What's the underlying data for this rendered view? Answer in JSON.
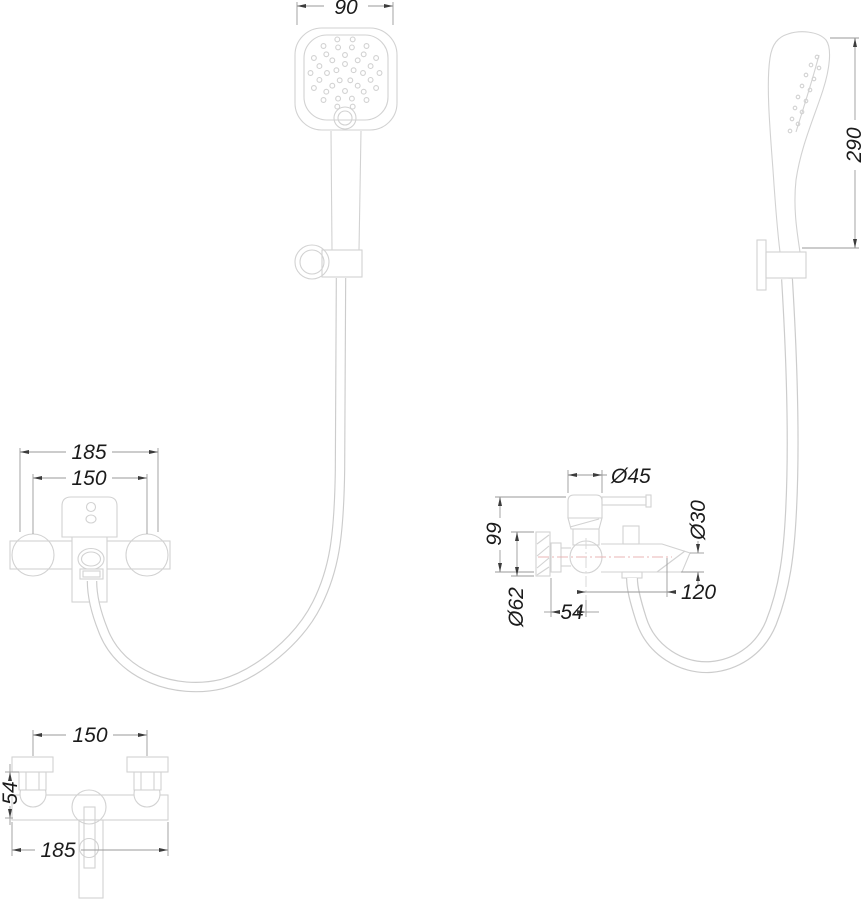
{
  "colors": {
    "outline": "#d2d2d2",
    "hose": "#cccccc",
    "dimension": "#9a9a9a",
    "arrow": "#3c3c3c",
    "text": "#1b1b1b",
    "centerline": "#e8b4b4"
  },
  "dims": {
    "head_width": "90",
    "handset_height": "290",
    "front_overall": "185",
    "front_centers": "150",
    "side_cartridge": "Ø45",
    "side_height": "99",
    "side_flange": "Ø62",
    "side_depth": "54",
    "side_spout": "Ø30",
    "side_reach": "120",
    "top_centers": "150",
    "top_depth": "54",
    "top_overall": "185"
  }
}
